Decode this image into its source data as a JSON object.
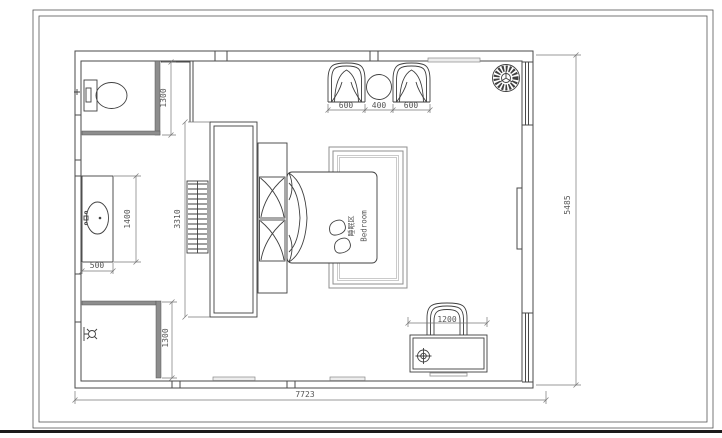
{
  "room_label": {
    "zh": "睡眠区",
    "en": "Bedroom"
  },
  "dimensions": {
    "overall_width": "7723",
    "overall_height": "5485",
    "toilet_room_depth": "1300",
    "shower_room_depth": "1300",
    "vanity_length": "1400",
    "vanity_depth": "500",
    "wardrobe_length": "3310",
    "armchair_left_width": "600",
    "side_table_width": "400",
    "armchair_right_width": "600",
    "desk_width": "1200"
  }
}
